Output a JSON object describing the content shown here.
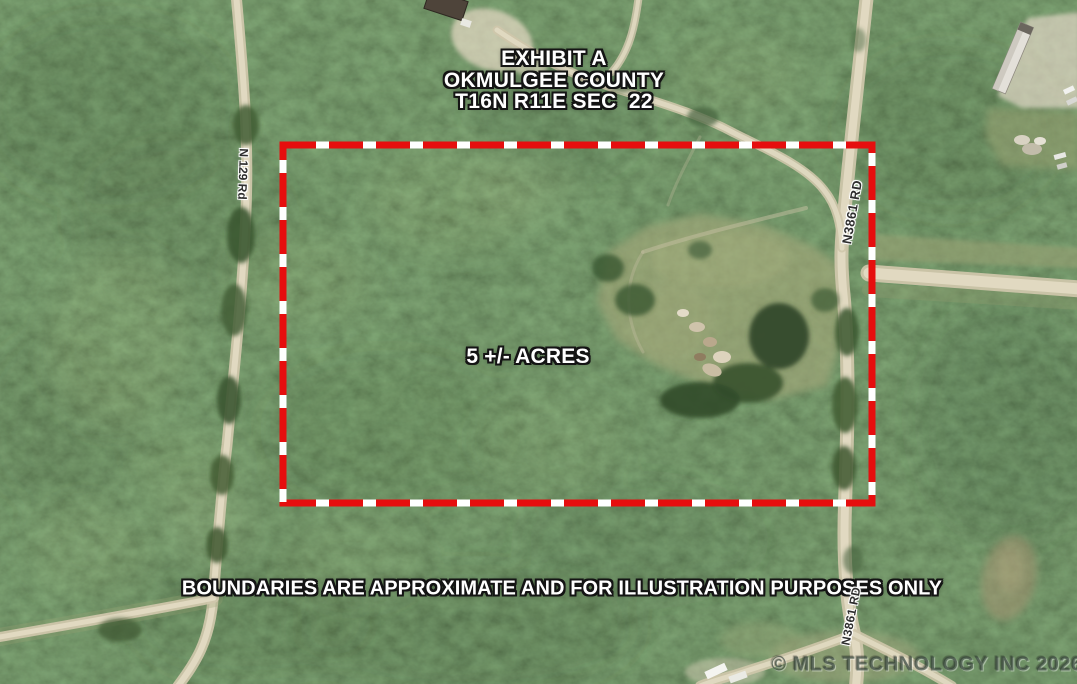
{
  "annotation": {
    "title_line1": "EXHIBIT A",
    "title_line2": "OKMULGEE COUNTY",
    "title_line3": "T16N R11E SEC  22",
    "acreage": "5 +/- ACRES",
    "disclaimer": "BOUNDARIES ARE APPROXIMATE AND FOR ILLUSTRATION PURPOSES ONLY",
    "watermark": "© MLS TECHNOLOGY INC 2026"
  },
  "roads": {
    "n129": "N 129 Rd",
    "n3861_upper": "N3861 RD",
    "n3861_lower": "N3861 RD"
  },
  "boundary": {
    "color": "#e60e0e",
    "dash_color": "#ffffff"
  }
}
